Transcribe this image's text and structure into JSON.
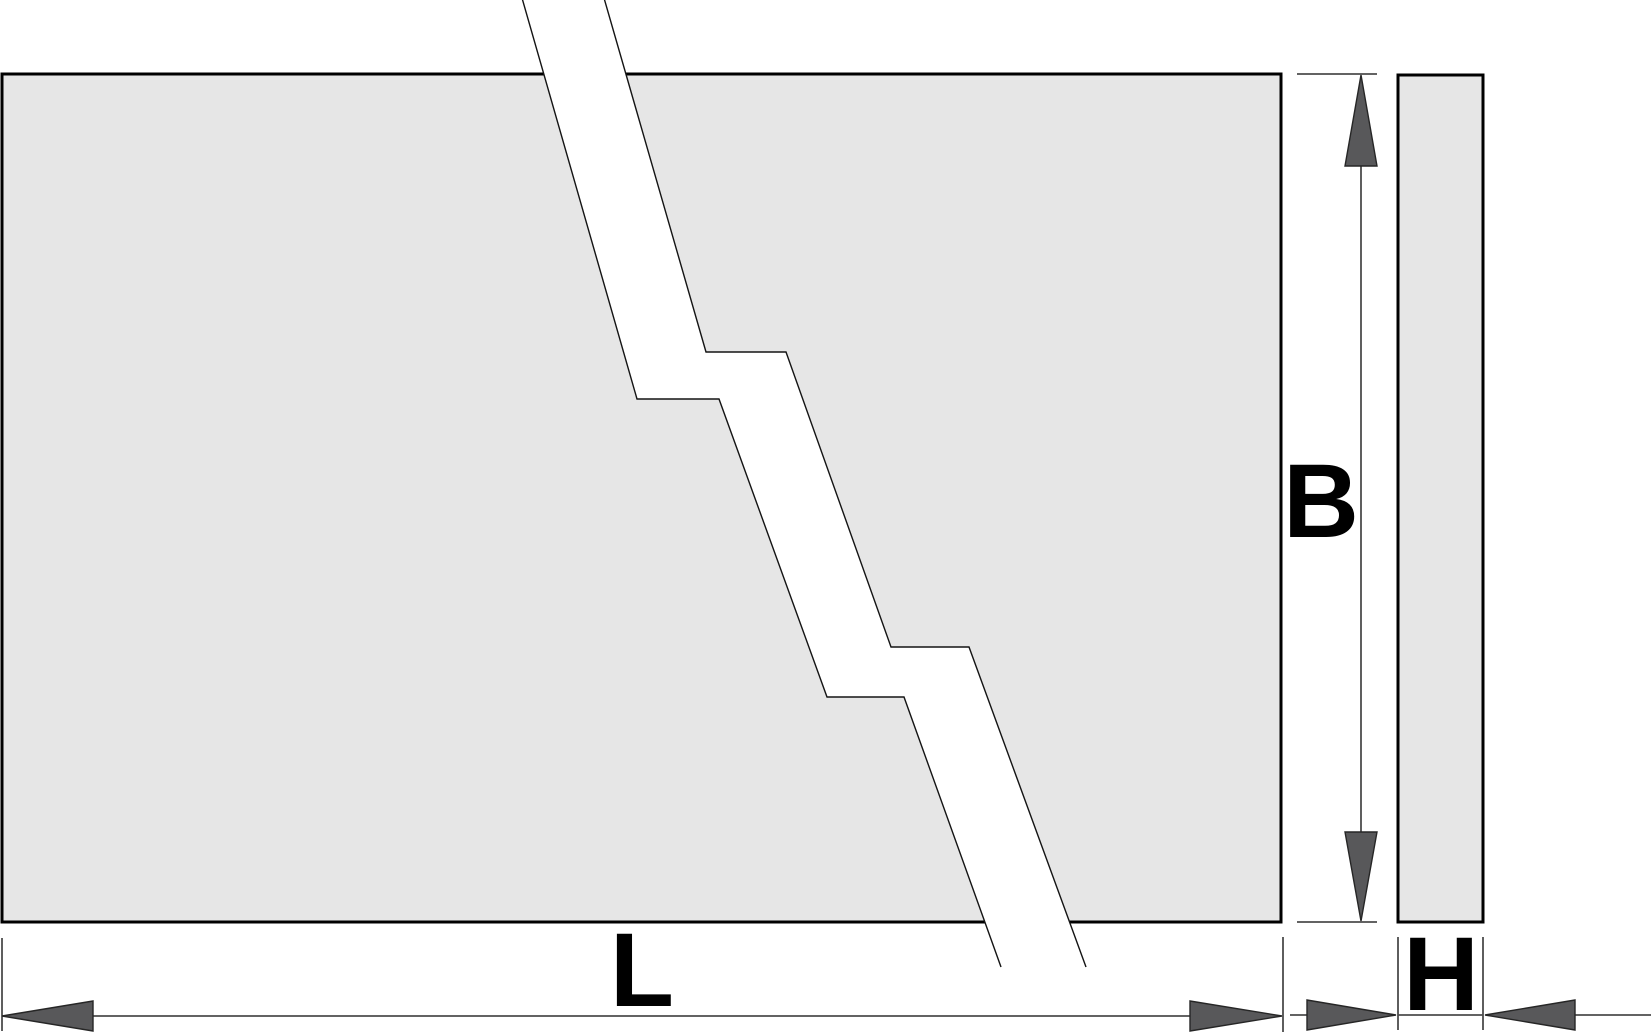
{
  "figure": {
    "type": "technical-drawing",
    "description": "Dimension diagram of a flat rectangular plate shown with break lines; top view with length L and breadth B, side view with thickness H",
    "dimension_labels": {
      "length": "L",
      "breadth": "B",
      "height": "H"
    },
    "colors": {
      "background": "#ffffff",
      "plate_fill": "#e6e6e6",
      "plate_outline": "#000000",
      "break_fill": "#ffffff",
      "break_outline": "#141414",
      "dimension_line": "#4d4d4d",
      "arrow_fill": "#58585a",
      "arrow_outline": "#262626",
      "label_text": "#000000"
    }
  }
}
